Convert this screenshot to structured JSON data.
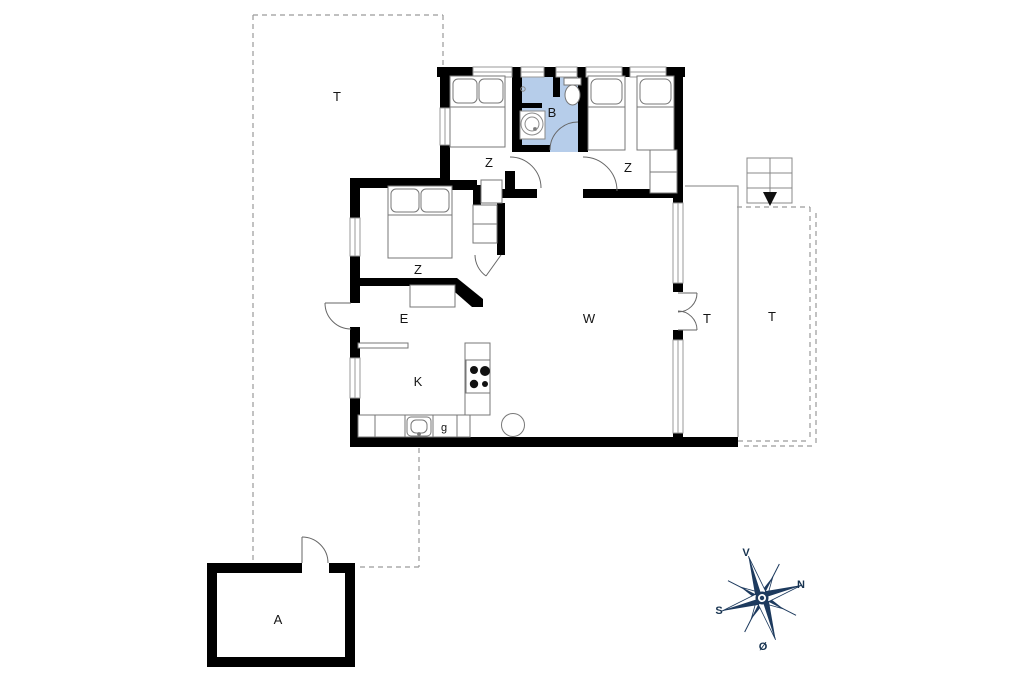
{
  "floorplan": {
    "rooms": {
      "terrace_left": {
        "label": "T"
      },
      "bedroom_top_left": {
        "label": "Z"
      },
      "bathroom": {
        "label": "B"
      },
      "bedroom_top_right": {
        "label": "Z"
      },
      "bedroom_middle": {
        "label": "Z"
      },
      "entry": {
        "label": "E"
      },
      "living_room": {
        "label": "W"
      },
      "kitchen": {
        "label": "K"
      },
      "kitchen_appliance": {
        "label": "g"
      },
      "terrace_at_door": {
        "label": "T"
      },
      "terrace_right": {
        "label": "T"
      },
      "annex": {
        "label": "A"
      }
    },
    "compass": {
      "top_label": "V",
      "right_label": "N",
      "left_label": "S",
      "bottom_label": "Ø"
    },
    "colors": {
      "wall": "#000000",
      "bathroom_fill": "#b6cdea",
      "compass": "#1d3a5e",
      "outline_gray": "#8a8a8a"
    }
  }
}
